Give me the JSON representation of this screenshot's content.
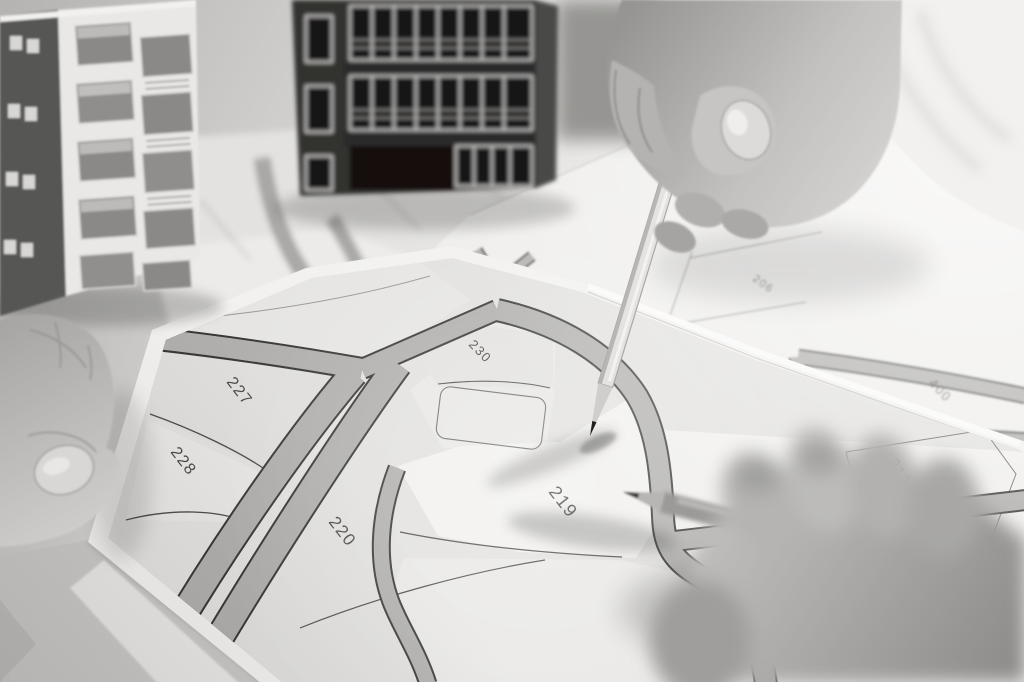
{
  "photo": {
    "style": "black-and-white",
    "subject": "hands-with-pencils-over-cadastral-parcel-map"
  },
  "map": {
    "parcel_labels": [
      {
        "id": "parcel-219",
        "label": "219"
      },
      {
        "id": "parcel-220",
        "label": "220"
      },
      {
        "id": "parcel-227",
        "label": "227"
      },
      {
        "id": "parcel-228",
        "label": "228"
      },
      {
        "id": "parcel-230",
        "label": "230"
      },
      {
        "id": "parcel-206",
        "label": "206"
      },
      {
        "id": "parcel-207",
        "label": "207"
      },
      {
        "id": "parcel-400",
        "label": "400"
      },
      {
        "id": "parcel-213",
        "label": "213"
      }
    ]
  },
  "colors": {
    "background": "#d9d8d6",
    "paper": "#f2f1ef",
    "parcel_fill": "#e2e1df",
    "road_fill": "#b0afad",
    "road_edge": "#383838",
    "boundary_line": "#4e4d4b",
    "label_ink": "#3e3d3b"
  }
}
